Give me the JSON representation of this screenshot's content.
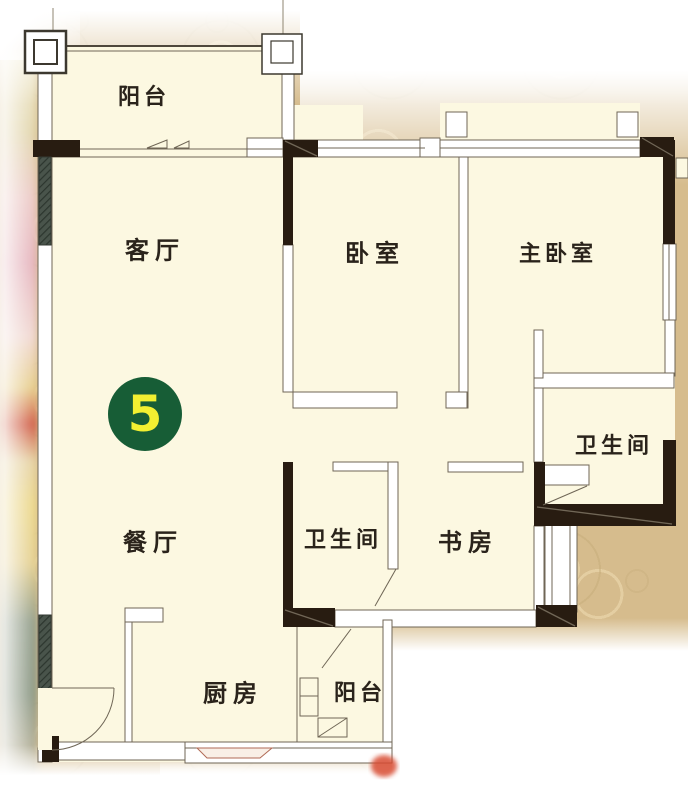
{
  "plan": {
    "unit_number": "5",
    "rooms": [
      {
        "id": "balcony-top",
        "label": "阳台"
      },
      {
        "id": "living-room",
        "label": "客厅"
      },
      {
        "id": "bedroom",
        "label": "卧室"
      },
      {
        "id": "master-bedroom",
        "label": "主卧室"
      },
      {
        "id": "bathroom-right",
        "label": "卫生间"
      },
      {
        "id": "dining-room",
        "label": "餐厅"
      },
      {
        "id": "bathroom-left",
        "label": "卫生间"
      },
      {
        "id": "study",
        "label": "书房"
      },
      {
        "id": "kitchen",
        "label": "厨房"
      },
      {
        "id": "balcony-bottom",
        "label": "阳台"
      }
    ],
    "colors": {
      "badge_green": "#175d36",
      "badge_number_yellow": "#f2ef31",
      "plan_fill": "#fcf8e1",
      "wall_dark": "#281c11",
      "wall_line": "#6f6656",
      "background_tan": "#d6bc8d"
    }
  }
}
